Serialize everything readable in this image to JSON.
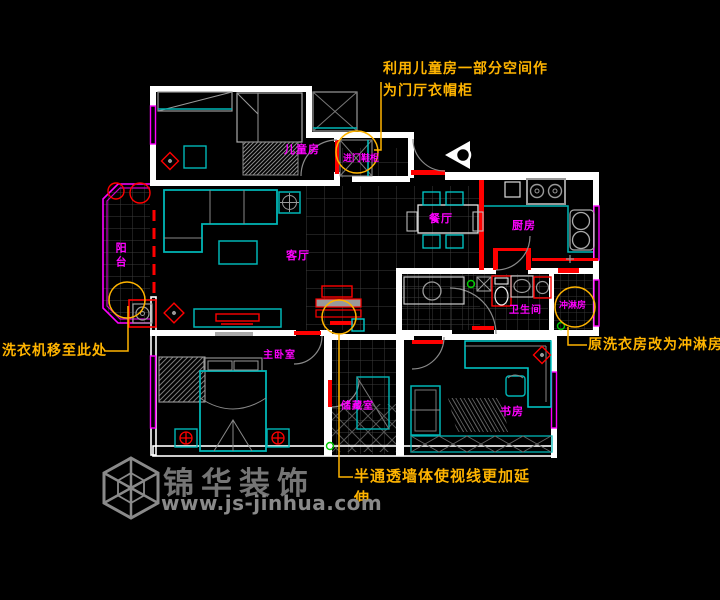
{
  "plan_title": "apartment-floor-plan",
  "rooms": {
    "children": "儿童房",
    "balcony": "阳台",
    "living": "客厅",
    "dining": "餐厅",
    "kitchen": "厨房",
    "bathroom": "卫生间",
    "shower": "冲淋房",
    "master": "主卧室",
    "storage": "储藏室",
    "study": "书房",
    "entry_cabinet": "进门鞋柜"
  },
  "annotations": {
    "top": {
      "line1": "利用儿童房一部分空间作",
      "line2": "为门厅衣帽柜"
    },
    "left": {
      "text": "洗衣机移至此处"
    },
    "right": {
      "text": "原洗衣房改为冲淋房"
    },
    "bottom": {
      "line1": "半通透墙体使视线更加延",
      "line2": "伸"
    }
  },
  "watermark": {
    "title": "锦华装饰",
    "url": "www.js-jinhua.com",
    "logo_icon": "isometric-cube-logo"
  },
  "colors": {
    "background": "#000000",
    "walls": "#ffffff",
    "furniture": "#00b6b6",
    "new_construction_red": "#ff0000",
    "room_label_magenta": "#ff00ff",
    "annotation_yellow": "#ffb400",
    "window_magenta": "#ff00ff",
    "grid_gray": "#3c3c3c",
    "watermark_gray": "#7a7a7a"
  }
}
